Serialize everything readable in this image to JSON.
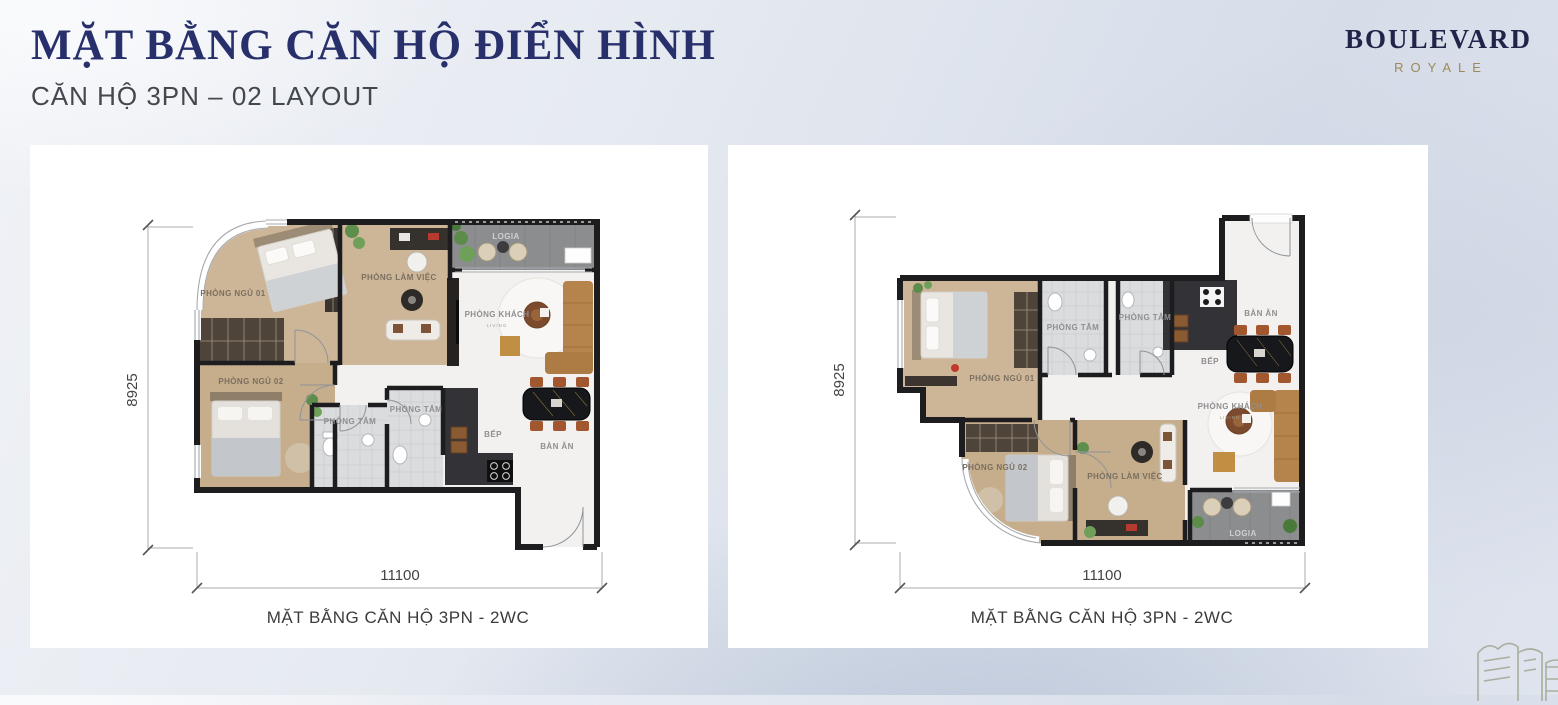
{
  "header": {
    "title": "MẶT BẰNG CĂN HỘ ĐIỂN HÌNH",
    "subtitle": "CĂN HỘ 3PN –  02 LAYOUT"
  },
  "logo": {
    "brand": "BOULEVARD",
    "brand_sub": "ROYALE"
  },
  "colors": {
    "title_navy": "#28306c",
    "logo_navy": "#1f2448",
    "logo_gold": "#9c8a58",
    "wall_dark": "#1d1d20",
    "wood_floor": "#cdb697",
    "sofa_tan": "#b5834c",
    "chair_rust": "#a3572f"
  },
  "plans": [
    {
      "caption": "MẶT BẰNG CĂN HỘ 3PN - 2WC",
      "dims": {
        "width": "11100",
        "height": "8925"
      },
      "rooms": {
        "bedroom1": "PHÒNG NGỦ 01",
        "bedroom2": "PHÒNG NGỦ 02",
        "work": "PHÒNG LÀM VIỆC",
        "living": "PHÒNG KHÁCH",
        "living_sub": "LIVING",
        "logia": "LOGIA",
        "bath1": "PHÒNG TẮM",
        "bath2": "PHÒNG TẮM",
        "kitchen": "BẾP",
        "dining": "BÀN ĂN"
      }
    },
    {
      "caption": "MẶT BẰNG CĂN HỘ 3PN - 2WC",
      "dims": {
        "width": "11100",
        "height": "8925"
      },
      "rooms": {
        "bedroom1": "PHÒNG NGỦ 01",
        "bedroom2": "PHÒNG NGỦ 02",
        "work": "PHÒNG LÀM VIỆC",
        "living": "PHÒNG KHÁCH",
        "living_sub": "LIVING",
        "logia": "LOGIA",
        "bath1": "PHÒNG TẮM",
        "bath2": "PHÒNG TẮM",
        "kitchen": "BẾP",
        "dining": "BÀN ĂN"
      }
    }
  ]
}
